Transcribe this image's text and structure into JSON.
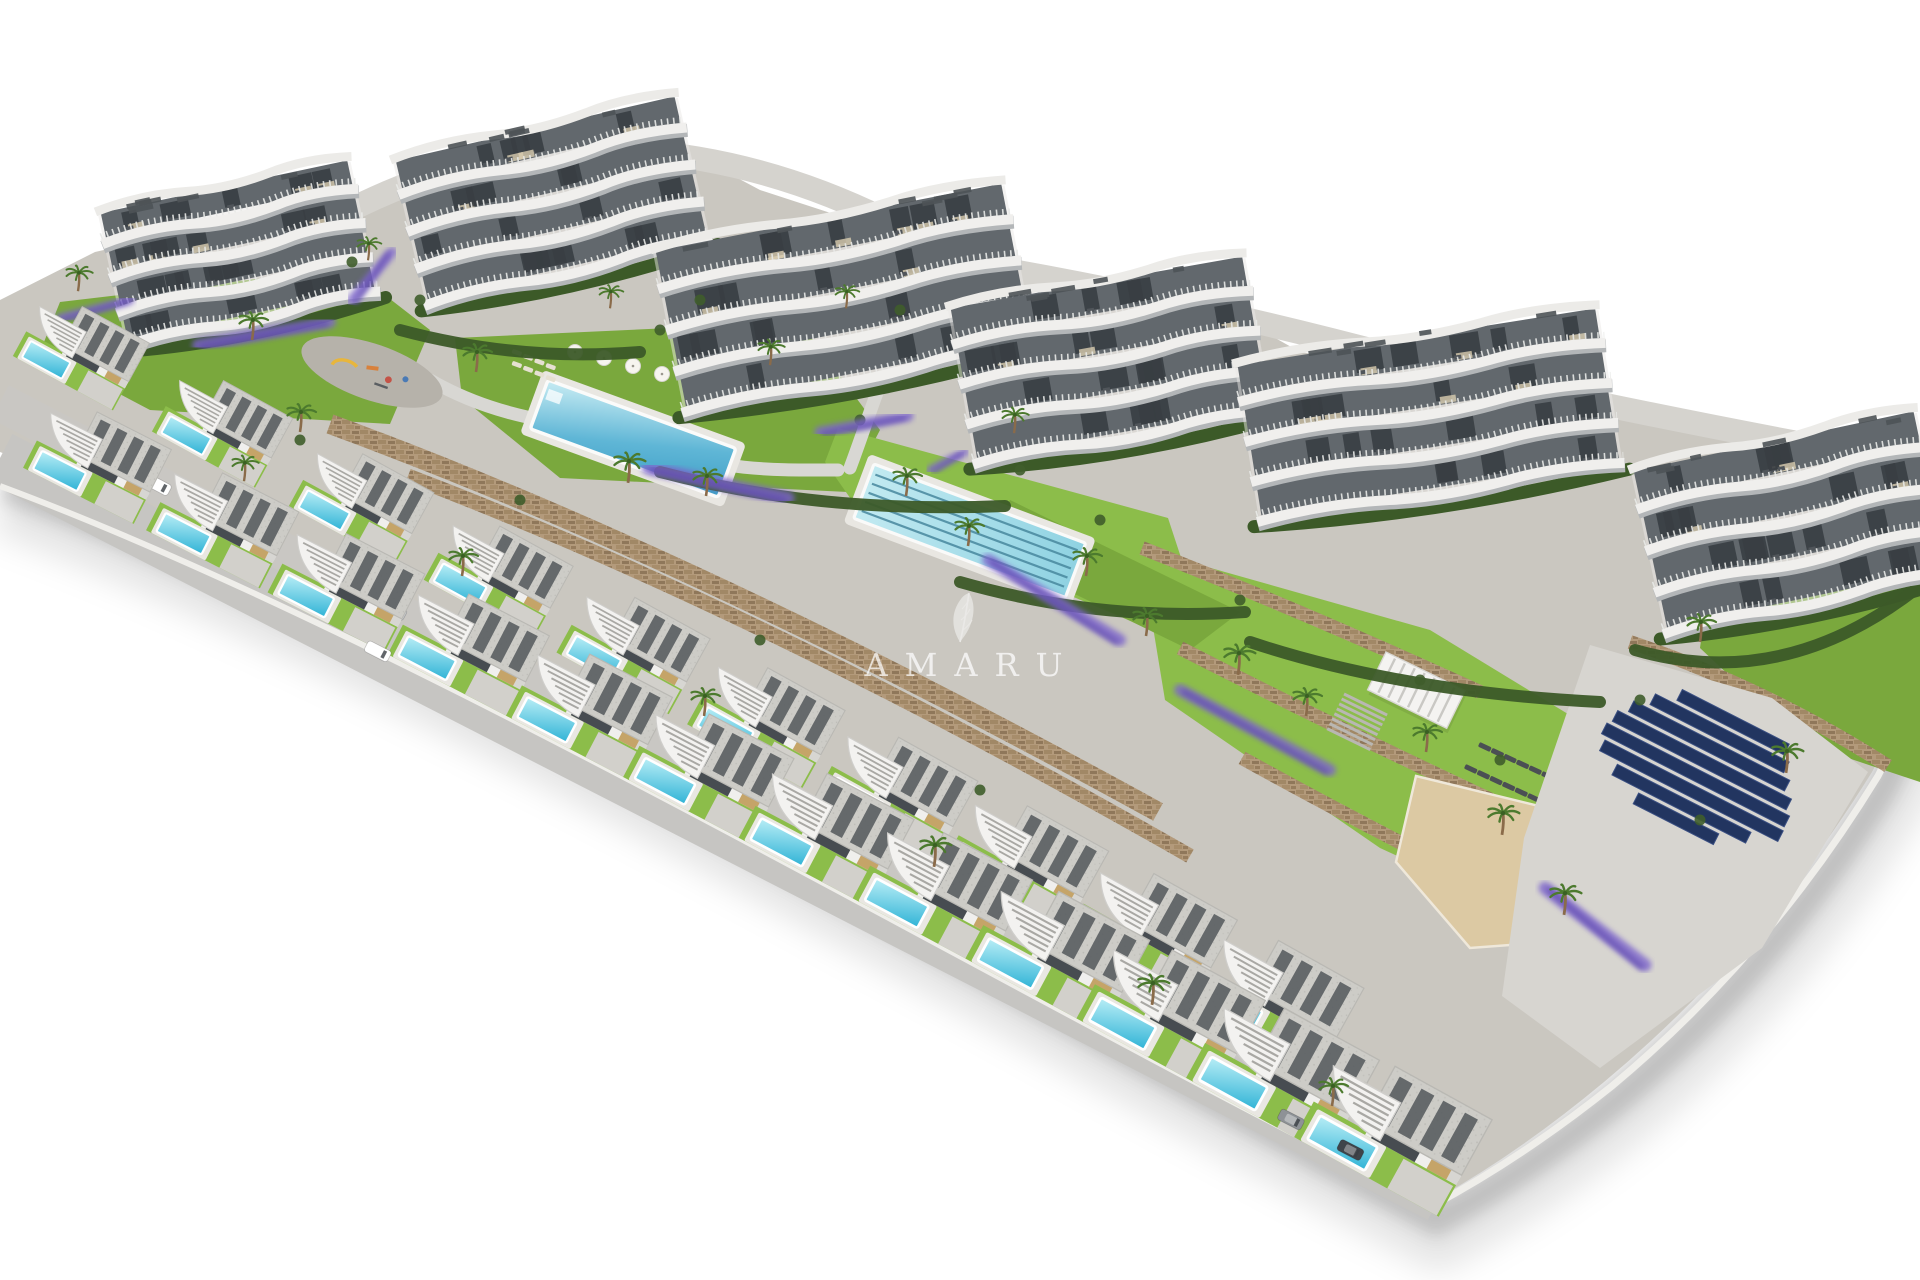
{
  "meta": {
    "title": "Aerial 3D architectural render of a hillside residential resort development",
    "camera": "aerial oblique three-quarter view",
    "background": "white studio fade"
  },
  "watermark": {
    "text": "AMARU",
    "icon": "feather-icon"
  },
  "scene": {
    "setting": "new-build Mediterranean residential complex on a terraced slope, isolated on white background",
    "apartment_buildings": {
      "count": 6,
      "floors": 4,
      "style": "white curved wave-edge balconies with glass railings, rooftop terraces with pergolas, hedge skirts"
    },
    "villas": {
      "front_row": 12,
      "back_row": 10,
      "features": [
        "gravel flat roof with pergola slats",
        "curved white entrance canopy with steps",
        "tan accent walls",
        "private plunge pool",
        "lawn",
        "driveway"
      ]
    },
    "amenities": {
      "community_pool": 1,
      "community_pool_parasols": 6,
      "lap_pool": 1,
      "lap_pool_lanes": 5,
      "playground": 1,
      "pergola": 1,
      "sun_lounger_rows": 2,
      "sand_area": 1,
      "solar_panel_rows": 8
    },
    "landscape": [
      "green lawns",
      "palm trees",
      "lavender beds",
      "stone retaining walls",
      "hedges",
      "internal roads"
    ],
    "vehicles": {
      "cars": 7
    },
    "palm_trees": 28
  },
  "palette": {
    "background": "#ffffff",
    "terrain": "#cac7c0",
    "road": "#c6c5c2",
    "road_mid": "#c9c7c3",
    "back_road": "#d5d3ce",
    "curb": "#efeeea",
    "lawn": "#7aa83d",
    "lawn_bright": "#8cbd4a",
    "hedge": "#3c5a28",
    "palm": "#4c7a2e",
    "trunk": "#8a6b4a",
    "stone": "#b39a7b",
    "stone_dark": "#a18866",
    "stone_deep": "#8f775a",
    "pool_light": "#b9eef6",
    "pool_deep": "#2fb3d6",
    "community_light": "#c8ecf3",
    "community_deep": "#3e9ec6",
    "lap_water": "#a6e0ea",
    "lane_line": "#48889e",
    "deck": "#e9e7e2",
    "building_white": "#f0efed",
    "building_under": "#b3b6b8",
    "recess": "#62686d",
    "window": "#383e43",
    "terrace_wood": "#d9cdb0",
    "roof_gravel": "#cdccc7",
    "roof_slat": "#565b5f",
    "villa_tan": "#c5a468",
    "villa_shade": "#d7d6d2",
    "opening": "#474c51",
    "solar": "#223560",
    "solar_frame": "#3a4f82",
    "pad": "#d7d5d0",
    "sand": "#dcc9a3",
    "lavender": "#7e66cc",
    "lavender_deep": "#5f48b0",
    "lounger": "#4b4f54",
    "watermark": "#ffffff",
    "vehicle_colors": [
      "#ffffff",
      "#c9ccd0",
      "#a97b4e",
      "#eceff1",
      "#8e9296",
      "#3f444a",
      "#ffffff"
    ]
  }
}
